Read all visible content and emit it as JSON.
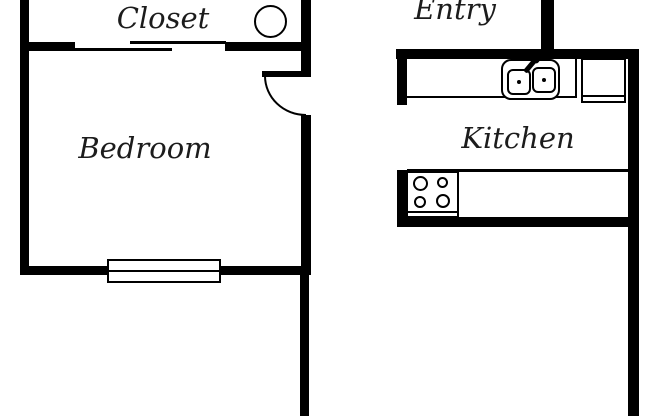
{
  "floorplan": {
    "background_color": "#ffffff",
    "wall_color": "#000000",
    "text_color": "#1c1c1c",
    "rooms": [
      {
        "name": "closet",
        "label": "Closet"
      },
      {
        "name": "entry",
        "label": "Entry"
      },
      {
        "name": "bedroom",
        "label": "Bedroom"
      },
      {
        "name": "kitchen",
        "label": "Kitchen"
      }
    ],
    "fixtures": [
      {
        "name": "closet-circle-fixture",
        "type": "circle"
      },
      {
        "name": "closet-sliding-door",
        "type": "bypass-door-two-lines"
      },
      {
        "name": "bedroom-door",
        "type": "door-with-swing-arc"
      },
      {
        "name": "bedroom-window",
        "type": "double-line-window"
      },
      {
        "name": "kitchen-counter",
        "type": "counter"
      },
      {
        "name": "kitchen-sink",
        "type": "double-basin-sink-with-faucet"
      },
      {
        "name": "refrigerator",
        "type": "counter-appliance-box"
      },
      {
        "name": "stove",
        "type": "four-burner-cooktop"
      }
    ]
  }
}
